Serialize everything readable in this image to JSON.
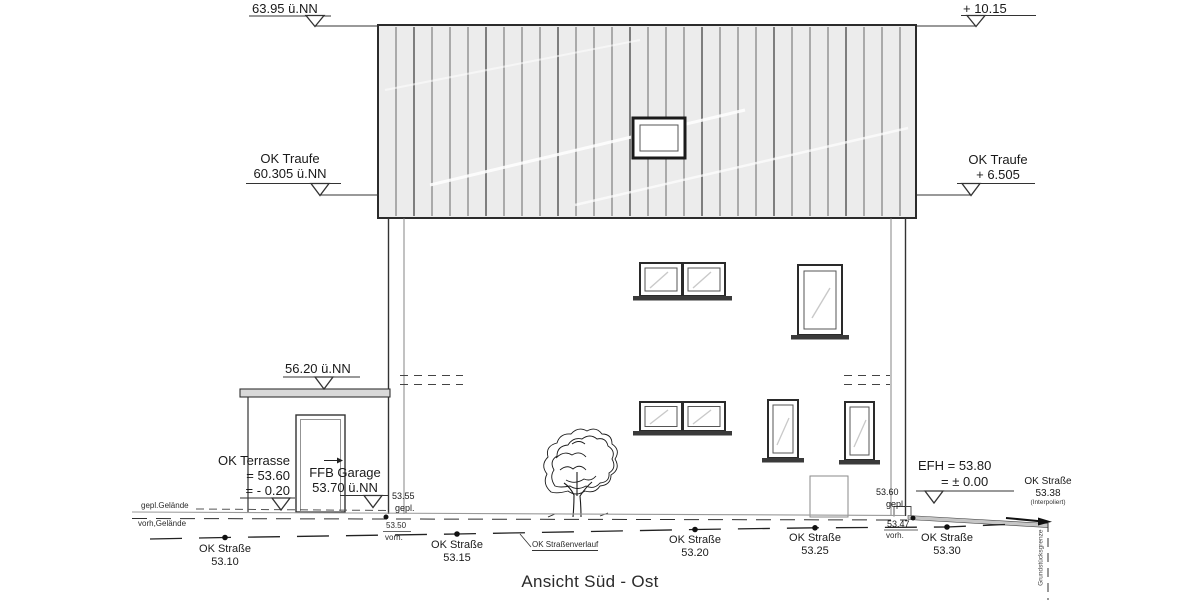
{
  "title": "Ansicht Süd - Ost",
  "markers": {
    "ridge_left": {
      "value": "63.95 ü.NN"
    },
    "ridge_right": {
      "value": "+ 10.15"
    },
    "traufe_left": {
      "name": "OK Traufe",
      "value": "60.305 ü.NN"
    },
    "traufe_right": {
      "name": "OK Traufe",
      "value": "+ 6.505"
    },
    "garage_roof": {
      "value": "56.20 ü.NN"
    },
    "terrasse": {
      "name": "OK Terrasse",
      "value": "= 53.60",
      "value2": "= - 0.20"
    },
    "ffb_garage": {
      "name": "FFB Garage",
      "value": "53.70 ü.NN"
    },
    "efh": {
      "name": "EFH = 53.80",
      "value": "= ± 0.00"
    }
  },
  "ground": {
    "planned_label": "gepl.Gelände",
    "existing_label": "vorh,Gelände",
    "left_point": {
      "planned": "53.55",
      "planned_suffix": "gepl.",
      "existing": "53.50",
      "existing_suffix": "vorh."
    },
    "right_point": {
      "planned": "53.60",
      "planned_suffix": "gepl.",
      "existing": "53.47",
      "existing_suffix": "vorh."
    },
    "street_course_label": "OK Straßenverlauf",
    "boundary_label": "Grundstücksgrenze"
  },
  "street": {
    "points": [
      {
        "label": "OK Straße",
        "value": "53.10"
      },
      {
        "label": "OK Straße",
        "value": "53.15"
      },
      {
        "label": "OK Straße",
        "value": "53.20"
      },
      {
        "label": "OK Straße",
        "value": "53.25"
      },
      {
        "label": "OK Straße",
        "value": "53.30"
      }
    ],
    "interpolated": {
      "label": "OK Straße",
      "value": "53.38",
      "note": "(Interpoliert)"
    }
  }
}
